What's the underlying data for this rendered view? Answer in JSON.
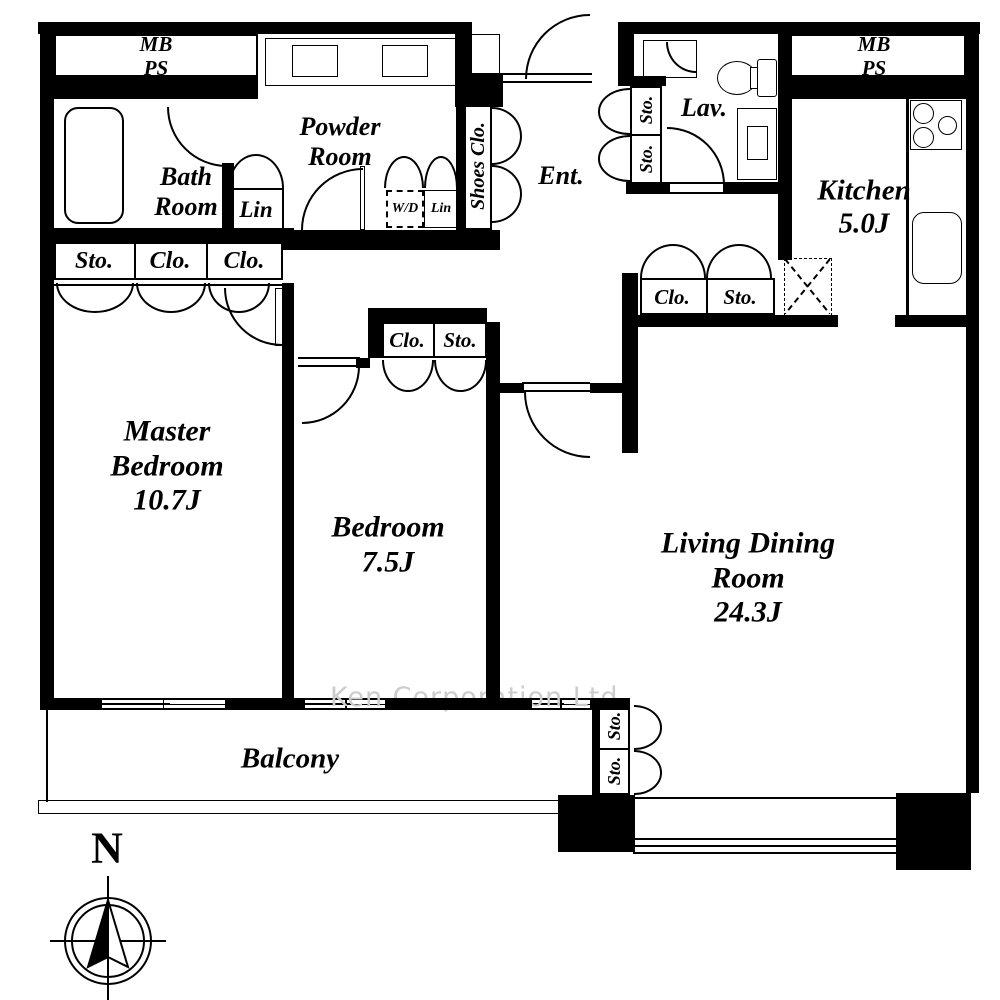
{
  "colors": {
    "wall": "#000000",
    "background": "#ffffff",
    "watermark": "#cccccc"
  },
  "rooms": {
    "master_bedroom": "Master\nBedroom\n10.7J",
    "bedroom": "Bedroom\n7.5J",
    "living_dining": "Living Dining Room\n24.3J",
    "kitchen": "Kitchen\n5.0J",
    "bath": "Bath\nRoom",
    "powder": "Powder\nRoom",
    "lavatory": "Lav.",
    "entrance": "Ent.",
    "balcony": "Balcony"
  },
  "closets": {
    "lin_large": "Lin",
    "wd": "W/D",
    "lin_small": "Lin",
    "shoes": "Shoes Clo.",
    "row_sto": "Sto.",
    "row_clo1": "Clo.",
    "row_clo2": "Clo.",
    "upper_sto1": "Sto.",
    "upper_sto2": "Sto.",
    "hall_clo": "Clo.",
    "hall_sto": "Sto.",
    "bedroom_clo": "Clo.",
    "bedroom_sto": "Sto.",
    "lower_sto1": "Sto.",
    "lower_sto2": "Sto."
  },
  "utilities": {
    "mb_ps_left": "MB\nPS",
    "mb_ps_right": "MB\nPS"
  },
  "compass": {
    "north": "N"
  },
  "watermark": "Ken Corporation Ltd.",
  "fixtures": {
    "bathtub": "bathtub",
    "toilet": "toilet",
    "vanity": "vanity-basin",
    "powder_basins": "twin-wash-basins",
    "stove": "3-burner-stove",
    "sink": "kitchen-sink",
    "refrigerator": "refrigerator-space",
    "washer": "washer-dryer-space"
  }
}
